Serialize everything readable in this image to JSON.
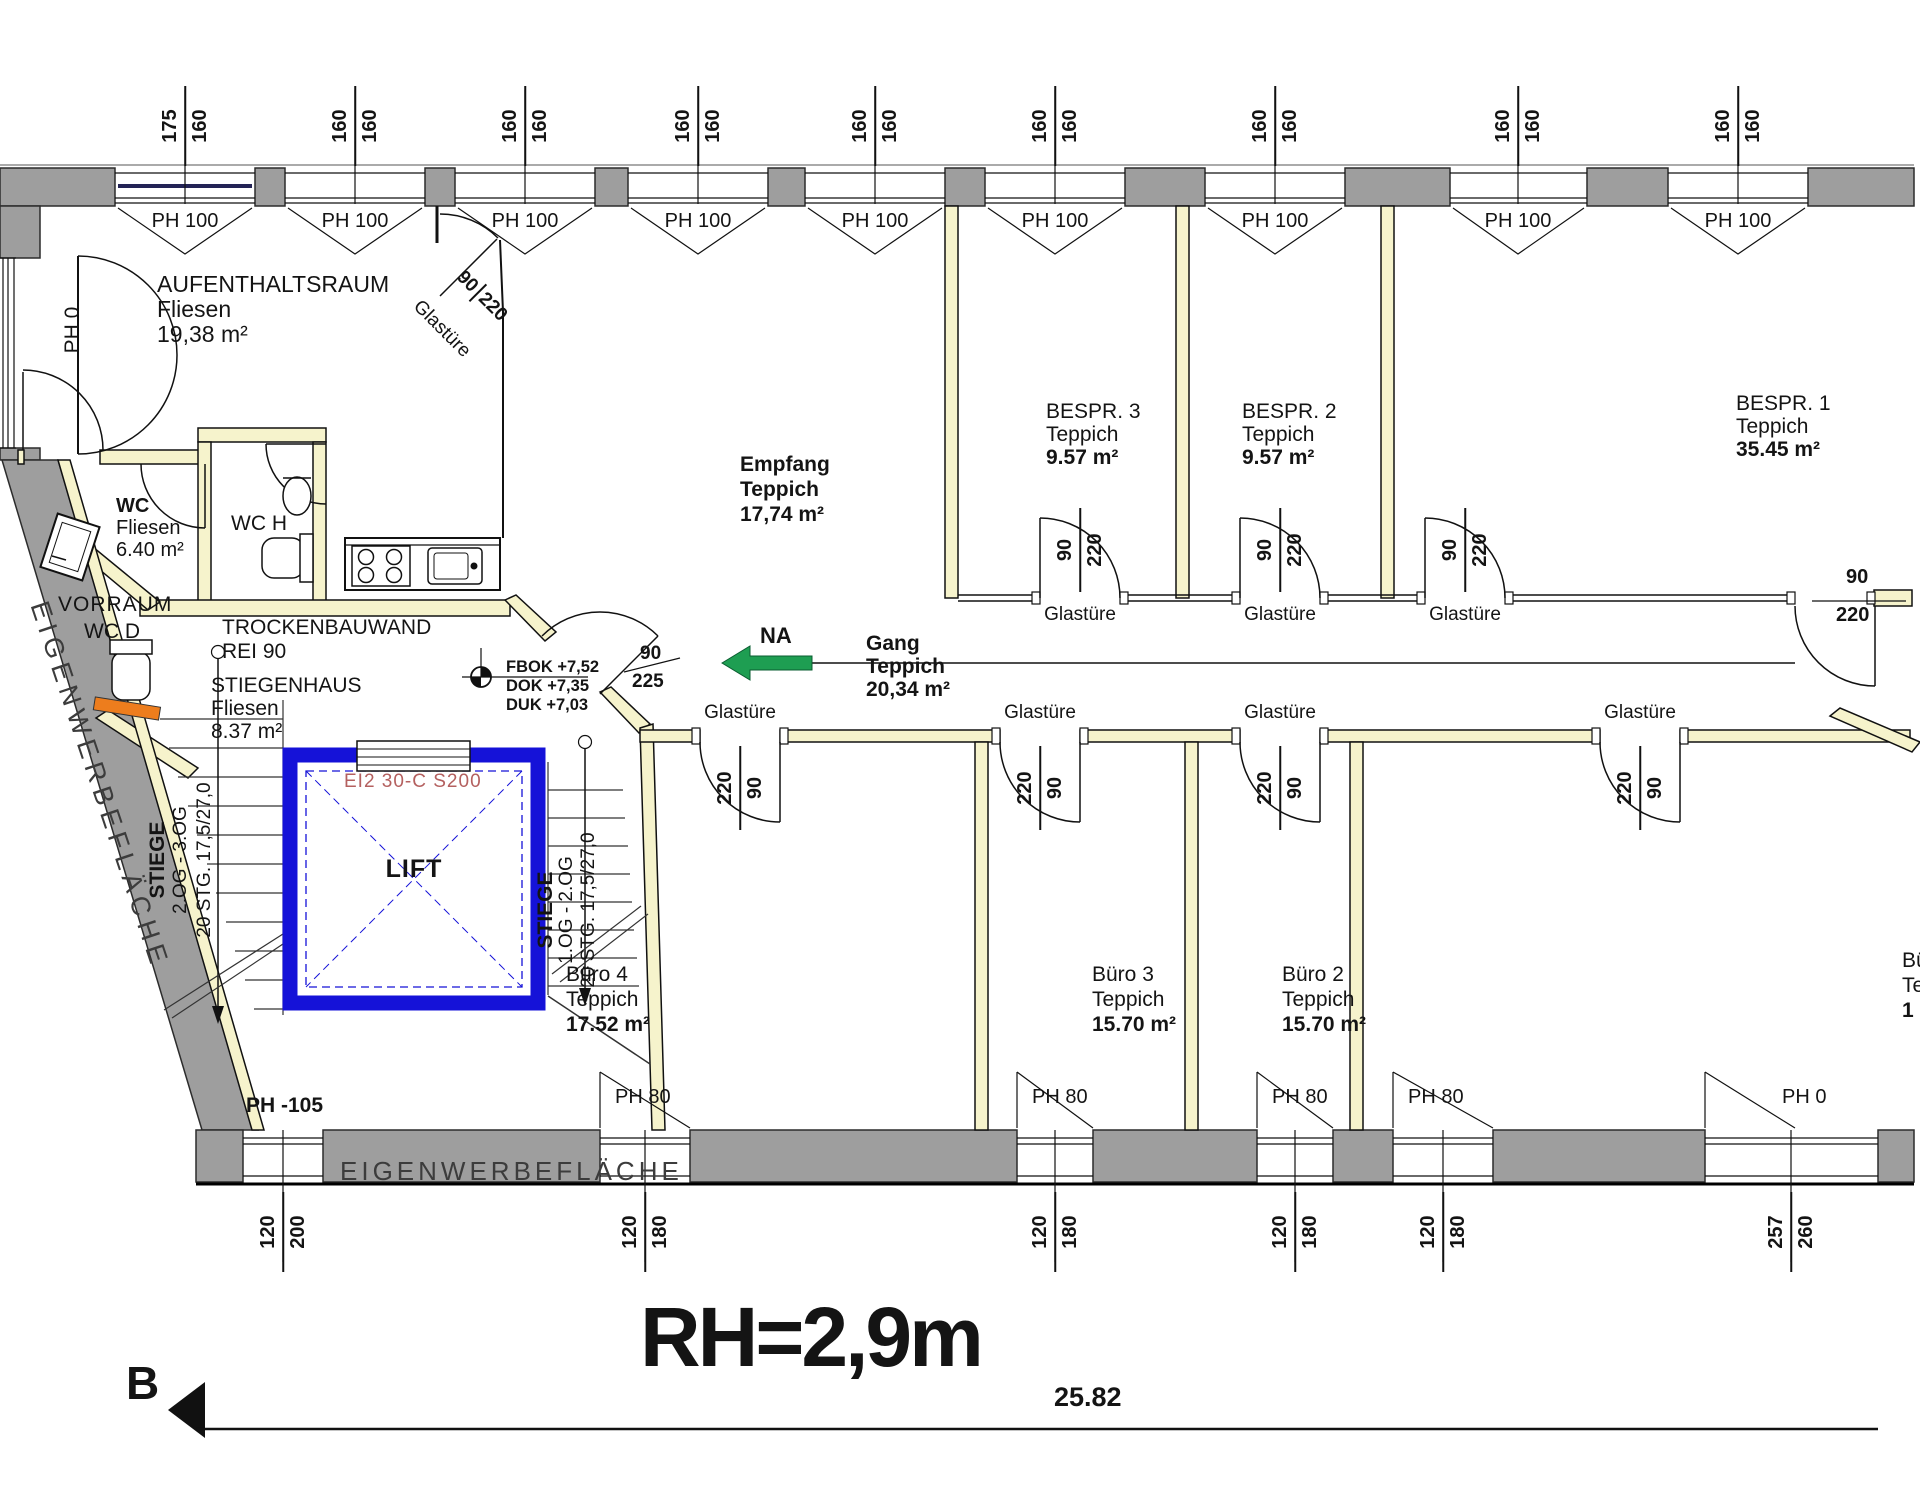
{
  "annotations": {
    "room_height": "RH=2,9m",
    "total_dimension": "25.82",
    "section_marker": "B"
  },
  "colors": {
    "wall_gray": "#9e9e9e",
    "partition_yellow": "#f6f3cc",
    "lift_blue": "#1512d8",
    "lift_rating_red": "#b4605f",
    "escape_green": "#1e9e52",
    "accent_orange": "#ed7d1d",
    "window_accent_navy": "#232355"
  },
  "rooms": {
    "aufenthaltsraum": {
      "name": "AUFENTHALTSRAUM",
      "material": "Fliesen",
      "area": "19,38 m²"
    },
    "wc": {
      "name": "WC",
      "material": "Fliesen",
      "area": "6.40 m²"
    },
    "wc_h": {
      "name": "WC H"
    },
    "vorraum": {
      "name": "VORRAUM"
    },
    "wc_d": {
      "name": "WC D"
    },
    "empfang": {
      "name": "Empfang",
      "material": "Teppich",
      "area": "17,74 m²"
    },
    "stiegenhaus": {
      "name": "STIEGENHAUS",
      "material": "Fliesen",
      "area": "8.37 m²"
    },
    "gang": {
      "name": "Gang",
      "material": "Teppich",
      "area": "20,34 m²"
    },
    "bespr3": {
      "name": "BESPR. 3",
      "material": "Teppich",
      "area": "9.57 m²"
    },
    "bespr2": {
      "name": "BESPR. 2",
      "material": "Teppich",
      "area": "9.57 m²"
    },
    "bespr1": {
      "name": "BESPR. 1",
      "material": "Teppich",
      "area": "35.45 m²"
    },
    "buero4": {
      "name": "Büro 4",
      "material": "Teppich",
      "area": "17.52 m²"
    },
    "buero3": {
      "name": "Büro 3",
      "material": "Teppich",
      "area": "15.70 m²"
    },
    "buero2": {
      "name": "Büro 2",
      "material": "Teppich",
      "area": "15.70 m²"
    },
    "buero1": {
      "name": "Büro 1",
      "material": "Teppich",
      "area": "1"
    }
  },
  "walls": {
    "trockenbauwand_line1": "TROCKENBAUWAND",
    "trockenbauwand_line2": "REI 90"
  },
  "levels": {
    "fbok": "FBOK +7,52",
    "dok": "DOK +7,35",
    "duk": "DUK +7,03"
  },
  "lift": {
    "label": "LIFT",
    "fire_rating": "EI2 30-C S200"
  },
  "stairs": {
    "left": {
      "l1": "STIEGE",
      "l2": "2.OG - 3.OG",
      "l3": "20 STG. 17,5/27,0"
    },
    "right": {
      "l1": "STIEGE",
      "l2": "1.OG - 2.OG",
      "l3": "20 STG. 17,5/27,0"
    }
  },
  "escape": {
    "label": "NA"
  },
  "advert": {
    "left": "EIGENWERBEFLÄCHE",
    "bottom": "EIGENWERBEFLÄCHE"
  },
  "top_windows": [
    {
      "a": "175",
      "b": "160",
      "ph": "PH 100"
    },
    {
      "a": "160",
      "b": "160",
      "ph": "PH 100"
    },
    {
      "a": "160",
      "b": "160",
      "ph": "PH 100"
    },
    {
      "a": "160",
      "b": "160",
      "ph": "PH 100"
    },
    {
      "a": "160",
      "b": "160",
      "ph": "PH 100"
    },
    {
      "a": "160",
      "b": "160",
      "ph": "PH 100"
    },
    {
      "a": "160",
      "b": "160",
      "ph": "PH 100"
    },
    {
      "a": "160",
      "b": "160",
      "ph": "PH 100"
    },
    {
      "a": "160",
      "b": "160",
      "ph": "PH 100"
    }
  ],
  "bottom_windows": [
    {
      "ph": "PH -105",
      "a": "120",
      "b": "200"
    },
    {
      "ph": "PH 80",
      "a": "120",
      "b": "180"
    },
    {
      "ph": "PH 80",
      "a": "120",
      "b": "180"
    },
    {
      "ph": "PH 80",
      "a": "120",
      "b": "180"
    },
    {
      "ph": "PH 80",
      "a": "120",
      "b": "180"
    },
    {
      "ph": "PH 0",
      "a": "257",
      "b": "260"
    }
  ],
  "doors": {
    "entry": {
      "label": "PH 0"
    },
    "glass_aufenthalt": {
      "label": "Glastüre",
      "a": "90",
      "b": "220"
    },
    "stiegenhaus": {
      "a": "90",
      "b": "225"
    },
    "glass_top": [
      {
        "label": "Glastüre",
        "a": "90",
        "b": "220"
      },
      {
        "label": "Glastüre",
        "a": "90",
        "b": "220"
      },
      {
        "label": "Glastüre",
        "a": "90",
        "b": "220"
      }
    ],
    "glass_bottom": [
      {
        "label": "Glastüre",
        "a": "220",
        "b": "90"
      },
      {
        "label": "Glastüre",
        "a": "220",
        "b": "90"
      },
      {
        "label": "Glastüre",
        "a": "220",
        "b": "90"
      },
      {
        "label": "Glastüre",
        "a": "220",
        "b": "90"
      }
    ],
    "gang_end": {
      "a": "90",
      "b": "220"
    }
  }
}
